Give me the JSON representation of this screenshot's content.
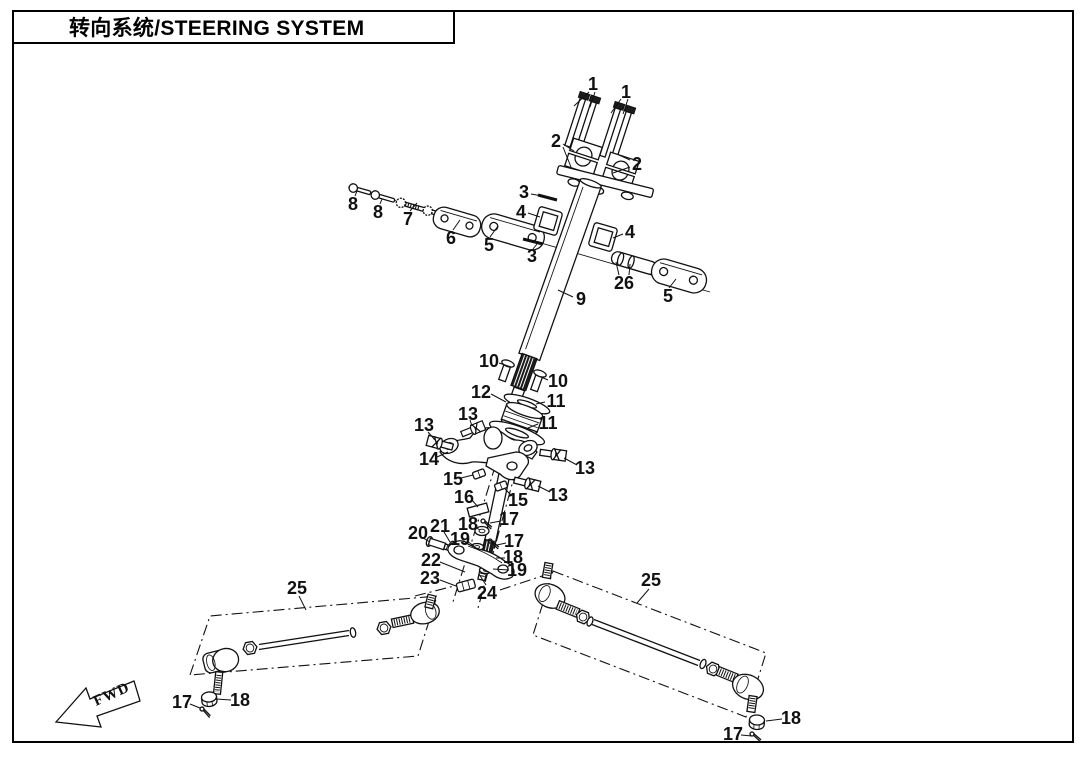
{
  "title": {
    "text": "转向系统/STEERING SYSTEM"
  },
  "direction_marker": {
    "label": "FWD"
  },
  "colors": {
    "ink": "#111111",
    "paper": "#ffffff"
  },
  "callouts": [
    {
      "label": "1",
      "x": 593,
      "y": 84,
      "leaders": [
        [
          589,
          92,
          574,
          106
        ],
        [
          595,
          92,
          590,
          107
        ]
      ]
    },
    {
      "label": "1",
      "x": 626,
      "y": 92,
      "leaders": [
        [
          621,
          99,
          611,
          113
        ],
        [
          628,
          99,
          623,
          114
        ]
      ]
    },
    {
      "label": "2",
      "x": 556,
      "y": 141,
      "leaders": [
        [
          563,
          144,
          574,
          151
        ],
        [
          563,
          147,
          571,
          167
        ]
      ]
    },
    {
      "label": "2",
      "x": 637,
      "y": 164,
      "leaders": [
        [
          630,
          160,
          619,
          155
        ],
        [
          630,
          167,
          613,
          173
        ]
      ]
    },
    {
      "label": "3",
      "x": 524,
      "y": 192,
      "leaders": [
        [
          531,
          194,
          548,
          197
        ]
      ]
    },
    {
      "label": "3",
      "x": 532,
      "y": 256,
      "leaders": [
        [
          533,
          249,
          537,
          244
        ]
      ]
    },
    {
      "label": "4",
      "x": 521,
      "y": 212,
      "leaders": [
        [
          528,
          213,
          540,
          217
        ]
      ]
    },
    {
      "label": "4",
      "x": 630,
      "y": 232,
      "leaders": [
        [
          623,
          234,
          613,
          238
        ]
      ]
    },
    {
      "label": "5",
      "x": 489,
      "y": 245,
      "leaders": [
        [
          490,
          237,
          498,
          226
        ]
      ]
    },
    {
      "label": "5",
      "x": 668,
      "y": 296,
      "leaders": [
        [
          669,
          288,
          676,
          279
        ]
      ]
    },
    {
      "label": "6",
      "x": 451,
      "y": 238,
      "leaders": [
        [
          453,
          230,
          460,
          220
        ]
      ]
    },
    {
      "label": "7",
      "x": 408,
      "y": 219,
      "leaders": [
        [
          410,
          211,
          417,
          203
        ]
      ]
    },
    {
      "label": "8",
      "x": 353,
      "y": 204,
      "leaders": [
        [
          355,
          196,
          357,
          191
        ]
      ]
    },
    {
      "label": "8",
      "x": 378,
      "y": 212,
      "leaders": [
        [
          380,
          204,
          382,
          199
        ]
      ]
    },
    {
      "label": "9",
      "x": 581,
      "y": 299,
      "leaders": [
        [
          573,
          297,
          558,
          290
        ]
      ]
    },
    {
      "label": "10",
      "x": 489,
      "y": 361,
      "leaders": [
        [
          499,
          363,
          511,
          367
        ]
      ]
    },
    {
      "label": "10",
      "x": 558,
      "y": 381,
      "leaders": [
        [
          548,
          380,
          541,
          377
        ]
      ]
    },
    {
      "label": "11",
      "x": 556,
      "y": 401,
      "leaders": [
        [
          545,
          402,
          536,
          404
        ]
      ]
    },
    {
      "label": "11",
      "x": 548,
      "y": 423,
      "leaders": [
        [
          538,
          424,
          528,
          428
        ]
      ]
    },
    {
      "label": "12",
      "x": 481,
      "y": 392,
      "leaders": [
        [
          491,
          394,
          506,
          402
        ]
      ]
    },
    {
      "label": "13",
      "x": 424,
      "y": 425,
      "leaders": [
        [
          428,
          432,
          435,
          440
        ]
      ]
    },
    {
      "label": "13",
      "x": 468,
      "y": 414,
      "leaders": [
        [
          470,
          420,
          472,
          426
        ]
      ]
    },
    {
      "label": "13",
      "x": 585,
      "y": 468,
      "leaders": [
        [
          577,
          465,
          564,
          458
        ]
      ]
    },
    {
      "label": "13",
      "x": 558,
      "y": 495,
      "leaders": [
        [
          550,
          492,
          538,
          486
        ]
      ]
    },
    {
      "label": "14",
      "x": 429,
      "y": 459,
      "leaders": [
        [
          437,
          457,
          448,
          452
        ]
      ]
    },
    {
      "label": "15",
      "x": 453,
      "y": 479,
      "leaders": [
        [
          461,
          478,
          473,
          475
        ]
      ]
    },
    {
      "label": "15",
      "x": 518,
      "y": 500,
      "leaders": [
        [
          512,
          496,
          505,
          489
        ]
      ]
    },
    {
      "label": "16",
      "x": 464,
      "y": 497,
      "leaders": [
        [
          472,
          500,
          478,
          507
        ]
      ]
    },
    {
      "label": "17",
      "x": 509,
      "y": 519,
      "leaders": [
        [
          501,
          521,
          490,
          523
        ]
      ]
    },
    {
      "label": "17",
      "x": 514,
      "y": 541,
      "leaders": [
        [
          506,
          543,
          497,
          545
        ]
      ]
    },
    {
      "label": "17",
      "x": 182,
      "y": 702,
      "leaders": [
        [
          190,
          704,
          200,
          708
        ]
      ]
    },
    {
      "label": "17",
      "x": 733,
      "y": 734,
      "leaders": [
        [
          741,
          735,
          752,
          736
        ]
      ]
    },
    {
      "label": "18",
      "x": 468,
      "y": 524,
      "leaders": [
        [
          475,
          527,
          480,
          530
        ]
      ]
    },
    {
      "label": "18",
      "x": 513,
      "y": 557,
      "leaders": [
        [
          505,
          558,
          496,
          558
        ]
      ]
    },
    {
      "label": "18",
      "x": 240,
      "y": 700,
      "leaders": [
        [
          231,
          700,
          216,
          699
        ]
      ]
    },
    {
      "label": "18",
      "x": 791,
      "y": 718,
      "leaders": [
        [
          782,
          719,
          766,
          721
        ]
      ]
    },
    {
      "label": "19",
      "x": 460,
      "y": 539,
      "leaders": [
        [
          467,
          541,
          474,
          546
        ]
      ]
    },
    {
      "label": "19",
      "x": 517,
      "y": 570,
      "leaders": [
        [
          509,
          570,
          493,
          569
        ]
      ]
    },
    {
      "label": "20",
      "x": 418,
      "y": 533,
      "leaders": [
        [
          423,
          538,
          430,
          542
        ]
      ]
    },
    {
      "label": "21",
      "x": 440,
      "y": 526,
      "leaders": [
        [
          444,
          532,
          450,
          542
        ]
      ]
    },
    {
      "label": "22",
      "x": 431,
      "y": 560,
      "leaders": [
        [
          440,
          562,
          465,
          572
        ]
      ]
    },
    {
      "label": "23",
      "x": 430,
      "y": 578,
      "leaders": [
        [
          440,
          580,
          456,
          586
        ]
      ]
    },
    {
      "label": "24",
      "x": 487,
      "y": 593,
      "leaders": [
        [
          486,
          585,
          479,
          574
        ]
      ]
    },
    {
      "label": "25",
      "x": 297,
      "y": 588,
      "leaders": [
        [
          299,
          596,
          306,
          610
        ]
      ]
    },
    {
      "label": "25",
      "x": 651,
      "y": 580,
      "leaders": [
        [
          649,
          589,
          637,
          603
        ]
      ]
    },
    {
      "label": "26",
      "x": 624,
      "y": 283,
      "leaders": [
        [
          619,
          275,
          616,
          262
        ],
        [
          629,
          275,
          630,
          264
        ]
      ]
    }
  ]
}
